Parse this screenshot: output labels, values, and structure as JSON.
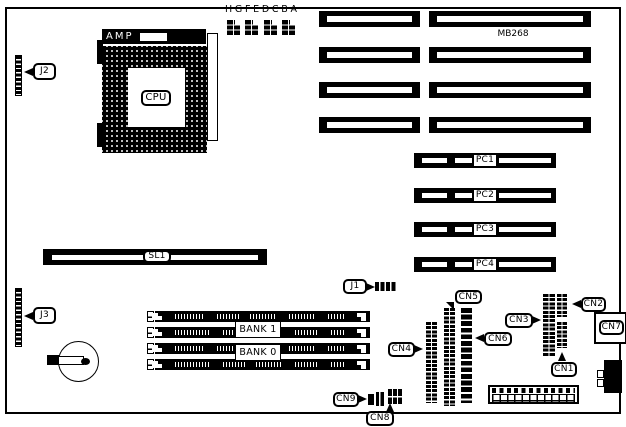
{
  "colors": {
    "ink": "#000000",
    "paper": "#ffffff"
  },
  "board": {
    "model_label": "MB268"
  },
  "cpu": {
    "socket_brand": "AMP",
    "chip_label": "CPU"
  },
  "jumpers": {
    "letters": [
      "H",
      "G",
      "F",
      "E",
      "D",
      "C",
      "B",
      "A"
    ]
  },
  "slots": {
    "sl1": "SL1",
    "pci": [
      "PC1",
      "PC2",
      "PC3",
      "PC4"
    ],
    "memory_banks": [
      "BANK 1",
      "BANK 0"
    ]
  },
  "connectors": {
    "j1": "J1",
    "j2": "J2",
    "j3": "J3",
    "cn1": "CN1",
    "cn2": "CN2",
    "cn3": "CN3",
    "cn4": "CN4",
    "cn5": "CN5",
    "cn6": "CN6",
    "cn7": "CN7",
    "cn8": "CN8",
    "cn9": "CN9"
  }
}
